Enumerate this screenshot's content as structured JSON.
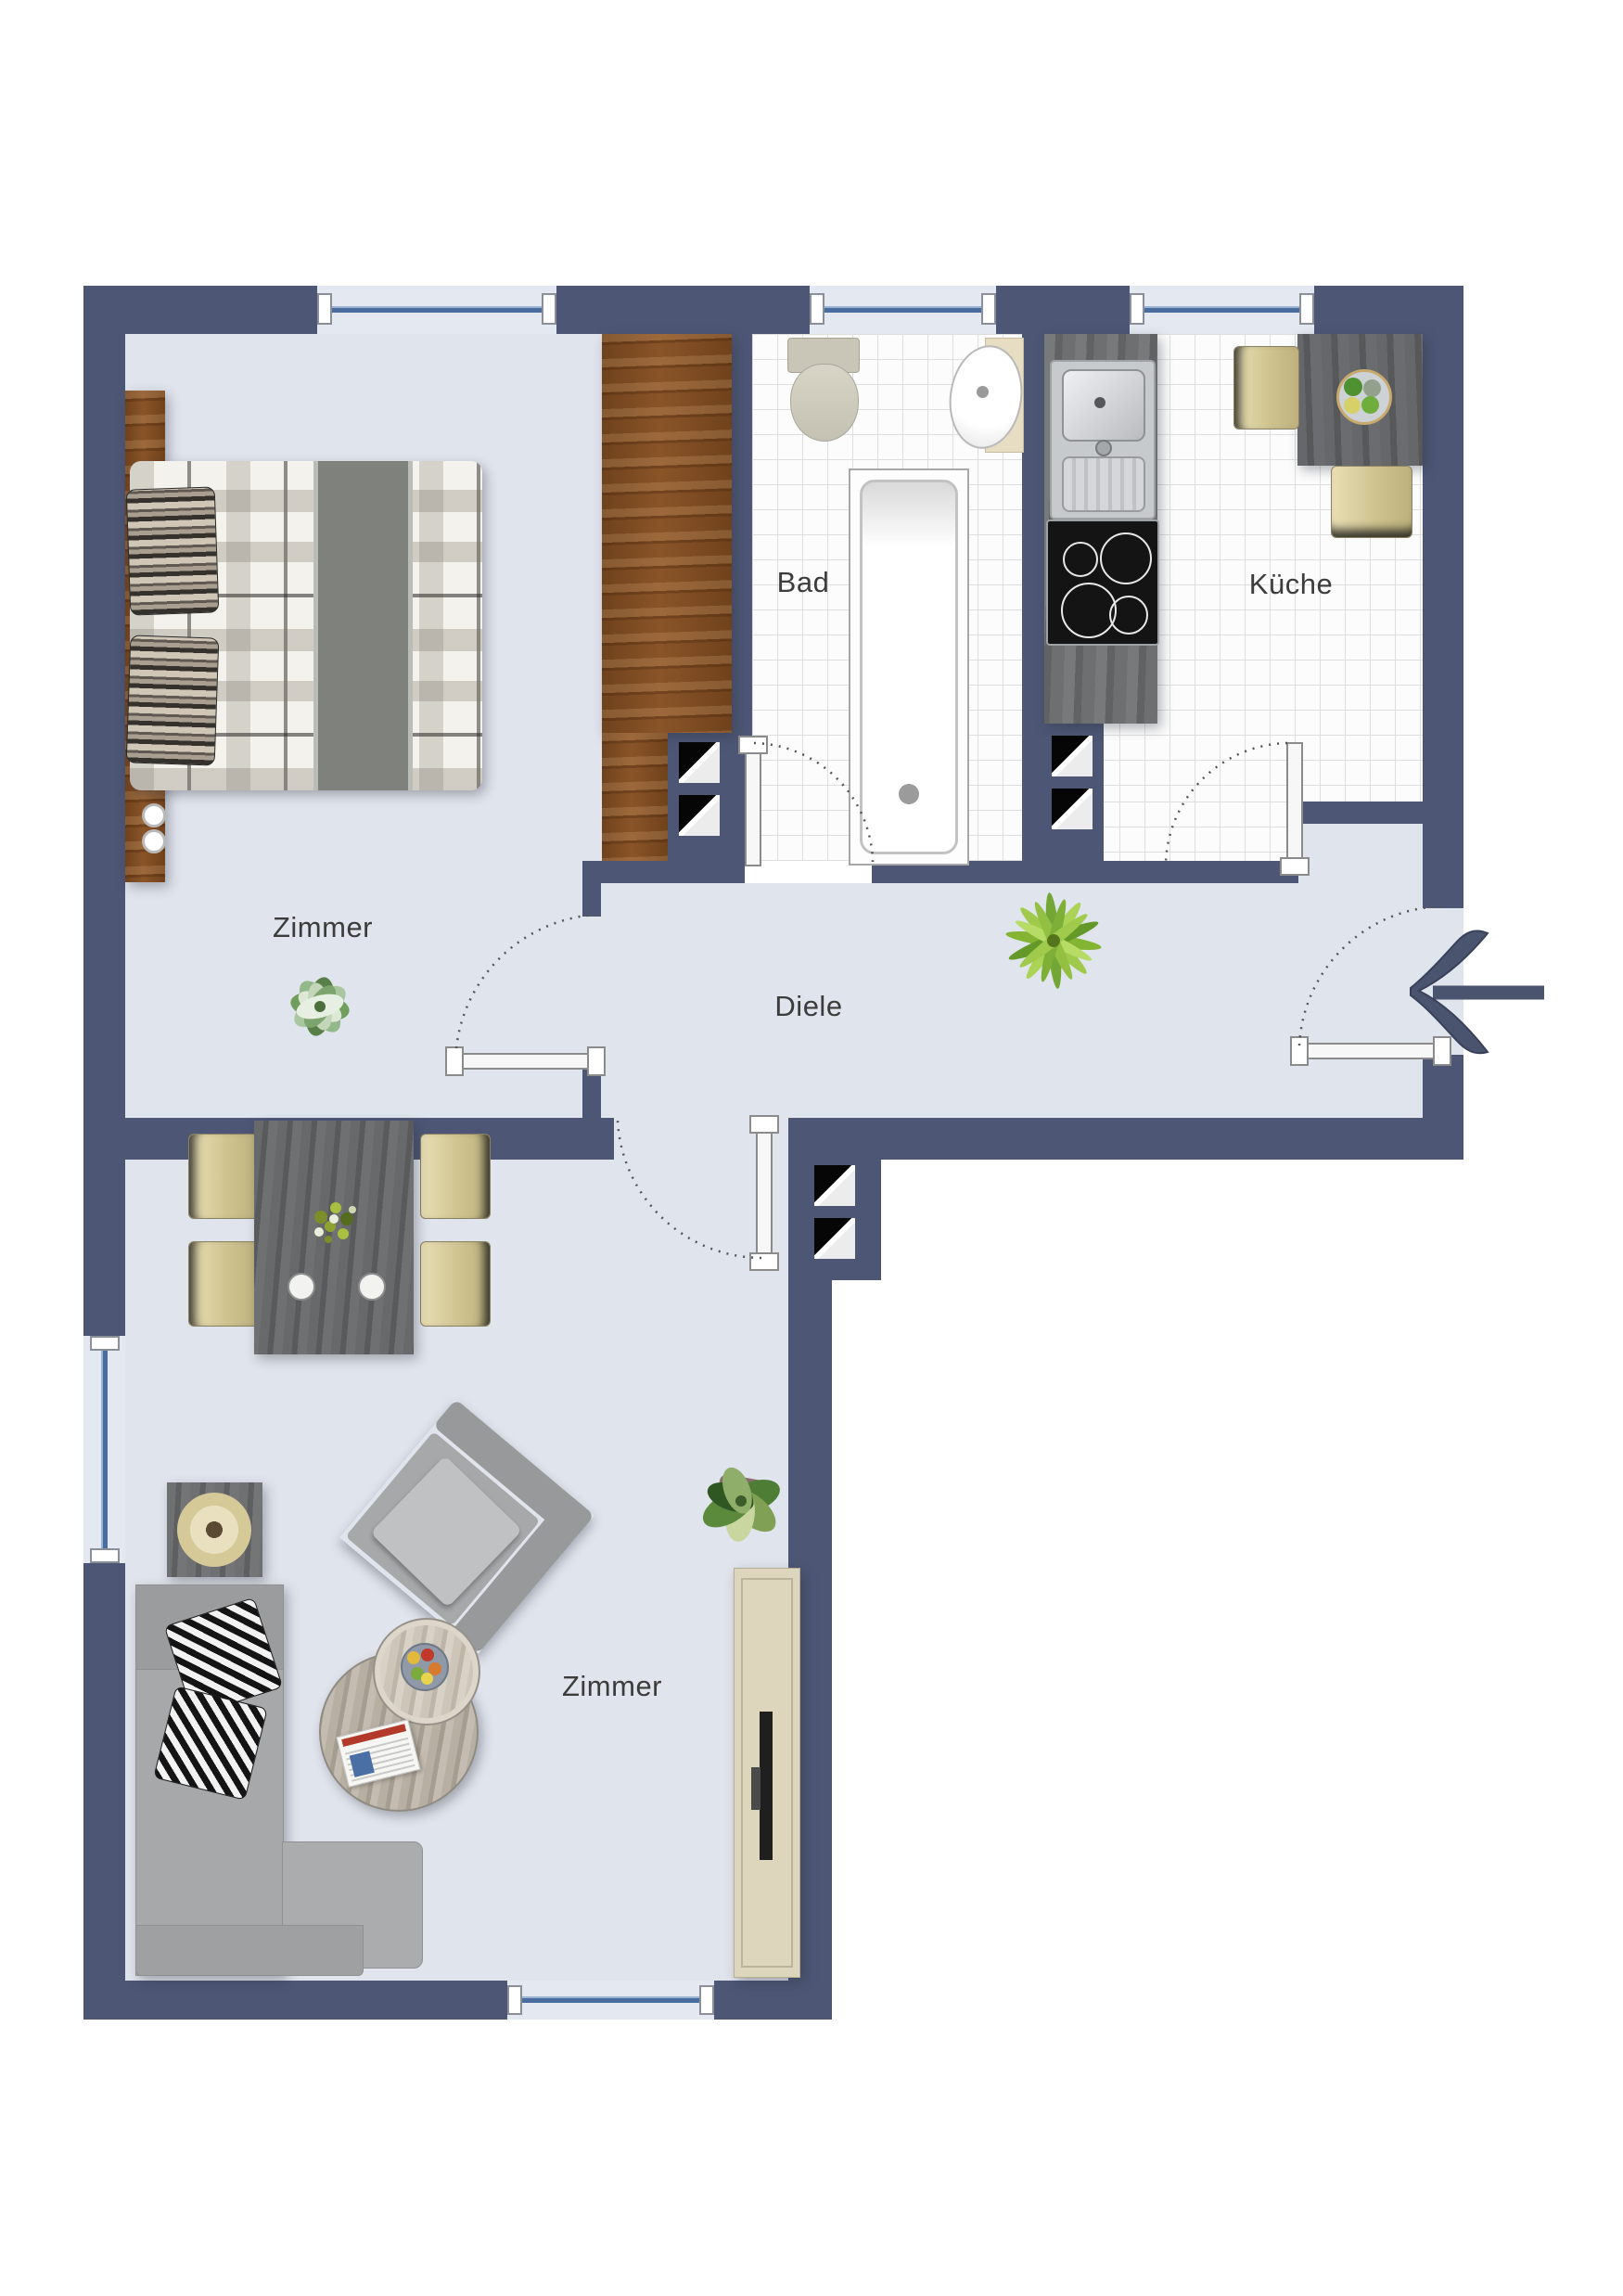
{
  "rooms": {
    "bedroom": {
      "label": "Zimmer"
    },
    "bathroom": {
      "label": "Bad"
    },
    "kitchen": {
      "label": "Küche"
    },
    "hallway": {
      "label": "Diele"
    },
    "living_room": {
      "label": "Zimmer"
    }
  },
  "colors": {
    "wall": "#4d5775",
    "floor": "#e0e4ec",
    "tile": "#fcfcfc",
    "tile_grid": "#dedede",
    "window_blue": "#4a6da0",
    "wood_dark": "#7b4a22",
    "wood_light": "#ddd6bd",
    "arrow": "#4a546f",
    "label_text": "#3c3c3c"
  }
}
